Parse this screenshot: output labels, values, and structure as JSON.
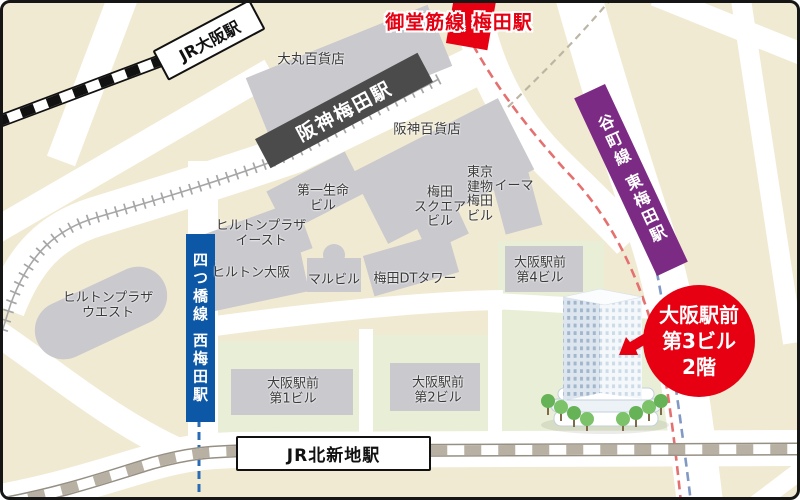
{
  "map": {
    "stations": {
      "jr_osaka": "JR大阪駅",
      "midosuji_umeda": "御堂筋線 梅田駅",
      "hanshin_umeda": "阪神梅田駅",
      "tanimachi_higashi_umeda": "谷町線 東梅田駅",
      "yotsubashi_nishi_umeda": "四つ橋線 西梅田駅",
      "jr_kitashinchi": "JR北新地駅"
    },
    "buildings": {
      "daimaru": "大丸百貨店",
      "hanshin_dept": "阪神百貨店",
      "daiichi_seimei": "第一生命\nビル",
      "hilton_plaza_east": "ヒルトンプラザ\nイースト",
      "hilton_osaka": "ヒルトン大阪",
      "hilton_plaza_west": "ヒルトンプラザ\nウエスト",
      "maru_building": "マルビル",
      "umeda_dt_tower": "梅田DTタワー",
      "umeda_square": "梅田\nスクエア\nビル",
      "tokyo_tatemono_umeda": "東京\n建物\n梅田\nビル",
      "e_ma": "イーマ",
      "osaka_ekimae_1": "大阪駅前\n第1ビル",
      "osaka_ekimae_2": "大阪駅前\n第2ビル",
      "osaka_ekimae_4": "大阪駅前\n第4ビル"
    },
    "destination": {
      "label": "大阪駅前\n第3ビル\n2階"
    },
    "colors": {
      "background": "#f1ead2",
      "road": "#ffffff",
      "building_gray": "#c9c9ce",
      "green_block": "#e9efd7",
      "midosuji_red": "#e60012",
      "tanimachi_purple": "#7c2b85",
      "yotsubashi_blue": "#0d57a7",
      "hanshin_dark": "#4b4b4b",
      "jr_line_black": "#111111",
      "kitashinchi_line_gray": "#b7b0a3",
      "destination_red": "#e60012"
    }
  }
}
